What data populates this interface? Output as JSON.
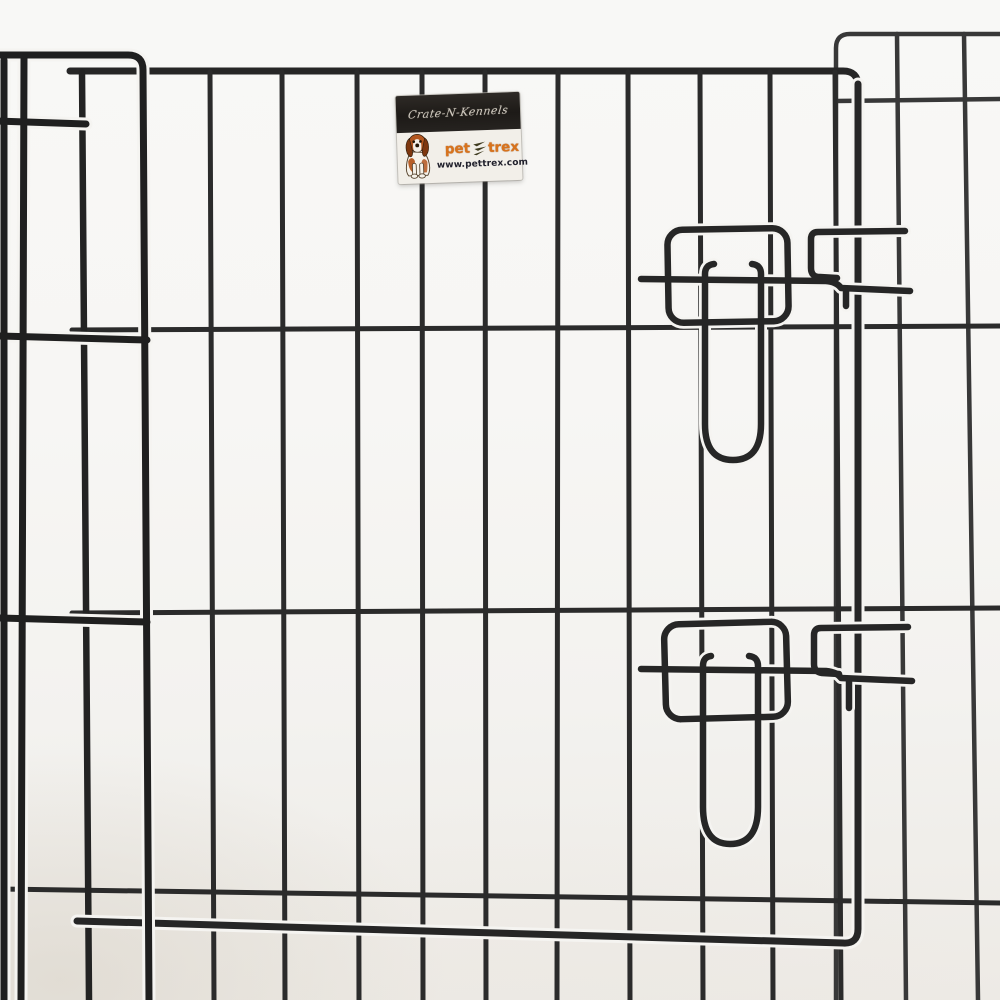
{
  "scene": {
    "subject": "black wire pet playpen panel with door, two wire slide latches and brand label",
    "latch_count": 2
  },
  "label": {
    "series_text": "Crate-N-Kennels",
    "brand_word1": "pet",
    "brand_word2": "trex",
    "website": "www.pettrex.com",
    "dog_icon": "beagle-dog-icon",
    "mark_icon": "pettrex-zigzag-icon"
  },
  "colors": {
    "wire": "#2b2b2b",
    "wire_front": "#1f1f1f",
    "wire_back": "#383838",
    "wire_latch": "#262626",
    "halo": "#f5f4f1",
    "label_band": "#221e1b",
    "label_bg": "#f2efe9",
    "brand_orange": "#d9731c",
    "website_color": "#20202c",
    "dog_brown": "#b3561f",
    "dog_dark": "#33200f"
  }
}
